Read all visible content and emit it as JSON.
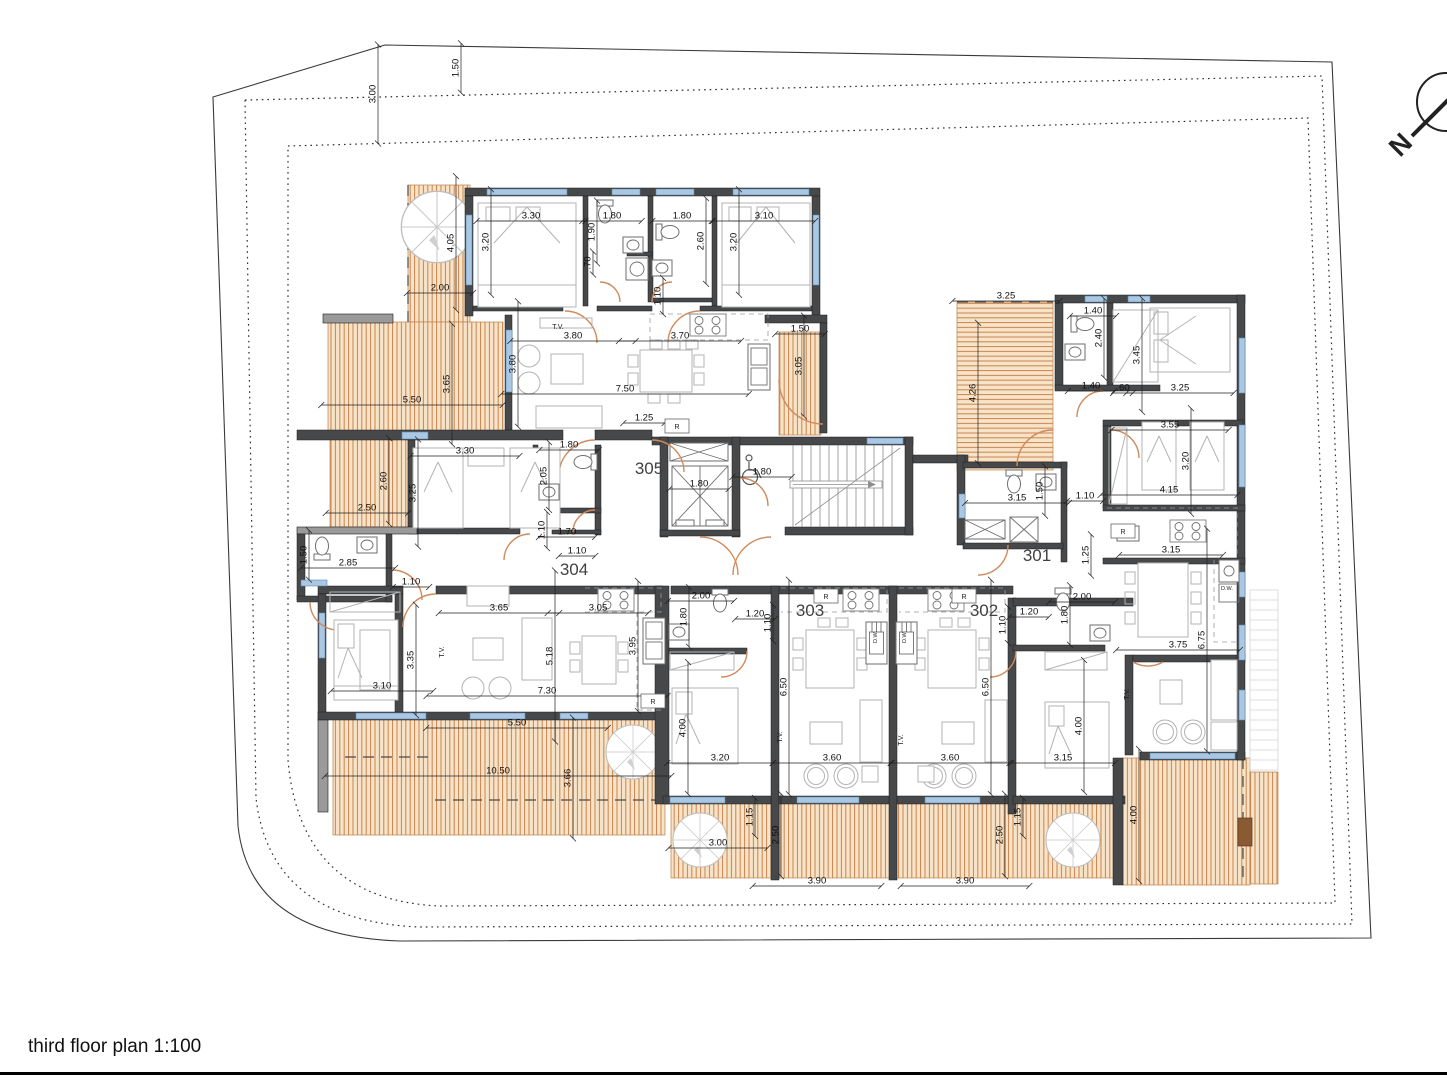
{
  "meta": {
    "title": "third floor plan 1:100",
    "scale": "1:100",
    "drawing": "architectural floor plan"
  },
  "north_arrow": {
    "label": "N"
  },
  "colors": {
    "wall": "#47484a",
    "window": "#aac7e4",
    "deck_bg": "#f6e3c8",
    "deck_stripe": "#c9854f",
    "door_arc": "#d08a5c",
    "furniture": "#b3b3b3",
    "dim_text": "#101010",
    "boundary": "#3a3a3a"
  },
  "units": [
    {
      "number": "305",
      "x": 649,
      "y": 474
    },
    {
      "number": "304",
      "x": 574,
      "y": 575
    },
    {
      "number": "303",
      "x": 810,
      "y": 616
    },
    {
      "number": "302",
      "x": 984,
      "y": 616
    },
    {
      "number": "301",
      "x": 1037,
      "y": 561
    }
  ],
  "dimensions": [
    {
      "t": "3.00",
      "x": 378,
      "y": 94,
      "r": -90
    },
    {
      "t": "1.50",
      "x": 461,
      "y": 68,
      "r": -90
    },
    {
      "t": "3.30",
      "x": 531,
      "y": 221,
      "r": 0
    },
    {
      "t": "1.90",
      "x": 597,
      "y": 232,
      "r": -90
    },
    {
      "t": "1.80",
      "x": 612,
      "y": 221,
      "r": 0
    },
    {
      "t": "1.80",
      "x": 682,
      "y": 221,
      "r": 0
    },
    {
      "t": "2.60",
      "x": 706,
      "y": 241,
      "r": -90
    },
    {
      "t": "3.10",
      "x": 764,
      "y": 221,
      "r": 0
    },
    {
      "t": "3.20",
      "x": 491,
      "y": 242,
      "r": -90
    },
    {
      "t": "3.20",
      "x": 739,
      "y": 242,
      "r": -90
    },
    {
      "t": ".70",
      "x": 593,
      "y": 263,
      "r": -90
    },
    {
      "t": "1.10",
      "x": 663,
      "y": 296,
      "r": -90
    },
    {
      "t": "4.05",
      "x": 456,
      "y": 243,
      "r": -90
    },
    {
      "t": "2.00",
      "x": 440,
      "y": 293,
      "r": 0
    },
    {
      "t": "3.80",
      "x": 518,
      "y": 364,
      "r": -90
    },
    {
      "t": "3.80",
      "x": 573,
      "y": 341,
      "r": 0
    },
    {
      "t": "3.70",
      "x": 680,
      "y": 341,
      "r": 0
    },
    {
      "t": "7.50",
      "x": 625,
      "y": 394,
      "r": 0
    },
    {
      "t": "1.25",
      "x": 644,
      "y": 423,
      "r": 0
    },
    {
      "t": "1.50",
      "x": 800,
      "y": 334,
      "r": 0
    },
    {
      "t": "3.05",
      "x": 804,
      "y": 366,
      "r": -90
    },
    {
      "t": "3.65",
      "x": 452,
      "y": 384,
      "r": -90
    },
    {
      "t": "5.50",
      "x": 412,
      "y": 405,
      "r": 0
    },
    {
      "t": "1.80",
      "x": 762,
      "y": 477,
      "r": 0
    },
    {
      "t": "1.80",
      "x": 699,
      "y": 489,
      "r": 0
    },
    {
      "t": "3.25",
      "x": 1006,
      "y": 301,
      "r": 0
    },
    {
      "t": "4.26",
      "x": 978,
      "y": 393,
      "r": -90
    },
    {
      "t": "1.40",
      "x": 1093,
      "y": 316,
      "r": 0
    },
    {
      "t": "2.40",
      "x": 1104,
      "y": 338,
      "r": -90
    },
    {
      "t": "3.45",
      "x": 1142,
      "y": 355,
      "r": -90
    },
    {
      "t": "1.40",
      "x": 1091,
      "y": 391,
      "r": 0
    },
    {
      "t": ".60",
      "x": 1123,
      "y": 393,
      "r": 0
    },
    {
      "t": "3.25",
      "x": 1180,
      "y": 393,
      "r": 0
    },
    {
      "t": "3.55",
      "x": 1170,
      "y": 430,
      "r": 0
    },
    {
      "t": "3.20",
      "x": 1191,
      "y": 461,
      "r": -90
    },
    {
      "t": "4.15",
      "x": 1169,
      "y": 495,
      "r": 0
    },
    {
      "t": "3.15",
      "x": 1017,
      "y": 503,
      "r": 0
    },
    {
      "t": "1.50",
      "x": 1045,
      "y": 491,
      "r": -90
    },
    {
      "t": "1.10",
      "x": 1085,
      "y": 501,
      "r": 0
    },
    {
      "t": "1.25",
      "x": 1091,
      "y": 555,
      "r": -90
    },
    {
      "t": "3.15",
      "x": 1171,
      "y": 555,
      "r": 0
    },
    {
      "t": "3.30",
      "x": 465,
      "y": 456,
      "r": 0
    },
    {
      "t": "3.25",
      "x": 418,
      "y": 493,
      "r": -90
    },
    {
      "t": "2.60",
      "x": 389,
      "y": 481,
      "r": -90
    },
    {
      "t": "2.50",
      "x": 367,
      "y": 513,
      "r": 0
    },
    {
      "t": "1.80",
      "x": 569,
      "y": 450,
      "r": 0
    },
    {
      "t": "2.05",
      "x": 549,
      "y": 476,
      "r": -90
    },
    {
      "t": "1.10",
      "x": 547,
      "y": 530,
      "r": -90
    },
    {
      "t": "1.70",
      "x": 567,
      "y": 537,
      "r": 0
    },
    {
      "t": "1.10",
      "x": 577,
      "y": 556,
      "r": 0
    },
    {
      "t": "1.50",
      "x": 309,
      "y": 555,
      "r": -90
    },
    {
      "t": "2.85",
      "x": 348,
      "y": 568,
      "r": 0
    },
    {
      "t": "1.10",
      "x": 411,
      "y": 587,
      "r": 0
    },
    {
      "t": "3.65",
      "x": 499,
      "y": 613,
      "r": 0
    },
    {
      "t": "3.05",
      "x": 598,
      "y": 613,
      "r": 0
    },
    {
      "t": "5.18",
      "x": 555,
      "y": 656,
      "r": -90
    },
    {
      "t": "3.95",
      "x": 638,
      "y": 646,
      "r": -90
    },
    {
      "t": "3.35",
      "x": 416,
      "y": 660,
      "r": -90
    },
    {
      "t": "3.10",
      "x": 382,
      "y": 691,
      "r": 0
    },
    {
      "t": "7.30",
      "x": 547,
      "y": 696,
      "r": 0
    },
    {
      "t": "2.00",
      "x": 701,
      "y": 601,
      "r": 0
    },
    {
      "t": "1.80",
      "x": 689,
      "y": 617,
      "r": -90
    },
    {
      "t": "1.20",
      "x": 755,
      "y": 619,
      "r": 0
    },
    {
      "t": "1.10",
      "x": 773,
      "y": 623,
      "r": -90
    },
    {
      "t": "1.20",
      "x": 1029,
      "y": 617,
      "r": 0
    },
    {
      "t": "1.10",
      "x": 1008,
      "y": 625,
      "r": -90
    },
    {
      "t": "1.80",
      "x": 1070,
      "y": 615,
      "r": -90
    },
    {
      "t": "2.00",
      "x": 1082,
      "y": 602,
      "r": 0
    },
    {
      "t": "6.50",
      "x": 789,
      "y": 687,
      "r": -90
    },
    {
      "t": "6.50",
      "x": 991,
      "y": 687,
      "r": -90
    },
    {
      "t": "6.75",
      "x": 1207,
      "y": 640,
      "r": -90
    },
    {
      "t": "3.75",
      "x": 1178,
      "y": 650,
      "r": 0
    },
    {
      "t": "4.00",
      "x": 688,
      "y": 728,
      "r": -90
    },
    {
      "t": "3.20",
      "x": 720,
      "y": 763,
      "r": 0
    },
    {
      "t": "3.60",
      "x": 832,
      "y": 763,
      "r": 0
    },
    {
      "t": "3.60",
      "x": 950,
      "y": 763,
      "r": 0
    },
    {
      "t": "3.15",
      "x": 1063,
      "y": 763,
      "r": 0
    },
    {
      "t": "4.00",
      "x": 1084,
      "y": 726,
      "r": -90
    },
    {
      "t": "5.50",
      "x": 517,
      "y": 728,
      "r": 0
    },
    {
      "t": "10.50",
      "x": 498,
      "y": 776,
      "r": 0
    },
    {
      "t": "3.66",
      "x": 573,
      "y": 778,
      "r": -90
    },
    {
      "t": "1.15",
      "x": 755,
      "y": 817,
      "r": -90
    },
    {
      "t": "2.50",
      "x": 781,
      "y": 835,
      "r": -90
    },
    {
      "t": "3.00",
      "x": 718,
      "y": 848,
      "r": 0
    },
    {
      "t": "3.90",
      "x": 817,
      "y": 886,
      "r": 0
    },
    {
      "t": "3.90",
      "x": 965,
      "y": 886,
      "r": 0
    },
    {
      "t": "2.50",
      "x": 1005,
      "y": 835,
      "r": -90
    },
    {
      "t": "1.15",
      "x": 1023,
      "y": 817,
      "r": -90
    },
    {
      "t": "4.00",
      "x": 1139,
      "y": 815,
      "r": -90
    }
  ],
  "fixture_labels": [
    {
      "t": "T.V.",
      "x": 558,
      "y": 329,
      "r": 0,
      "s": 7
    },
    {
      "t": "T.V.",
      "x": 444,
      "y": 652,
      "r": -90,
      "s": 7
    },
    {
      "t": "T.V.",
      "x": 782,
      "y": 737,
      "r": -90,
      "s": 7
    },
    {
      "t": "T.V.",
      "x": 903,
      "y": 740,
      "r": -90,
      "s": 7
    },
    {
      "t": "T.V.",
      "x": 1129,
      "y": 694,
      "r": -90,
      "s": 7
    },
    {
      "t": "R",
      "x": 677,
      "y": 429,
      "r": 0,
      "s": 7,
      "box": true
    },
    {
      "t": "R",
      "x": 1123,
      "y": 534,
      "r": 0,
      "s": 7,
      "box": true
    },
    {
      "t": "R",
      "x": 653,
      "y": 704,
      "r": 0,
      "s": 7,
      "box": true
    },
    {
      "t": "R",
      "x": 826,
      "y": 599,
      "r": 0,
      "s": 7,
      "box": true
    },
    {
      "t": "R",
      "x": 964,
      "y": 599,
      "r": 0,
      "s": 7,
      "box": true
    },
    {
      "t": "D.W.",
      "x": 877,
      "y": 637,
      "r": -90,
      "s": 5.5
    },
    {
      "t": "D.W.",
      "x": 906,
      "y": 637,
      "r": -90,
      "s": 5.5
    },
    {
      "t": "D.W.",
      "x": 1227,
      "y": 590,
      "r": 0,
      "s": 5.5
    }
  ]
}
